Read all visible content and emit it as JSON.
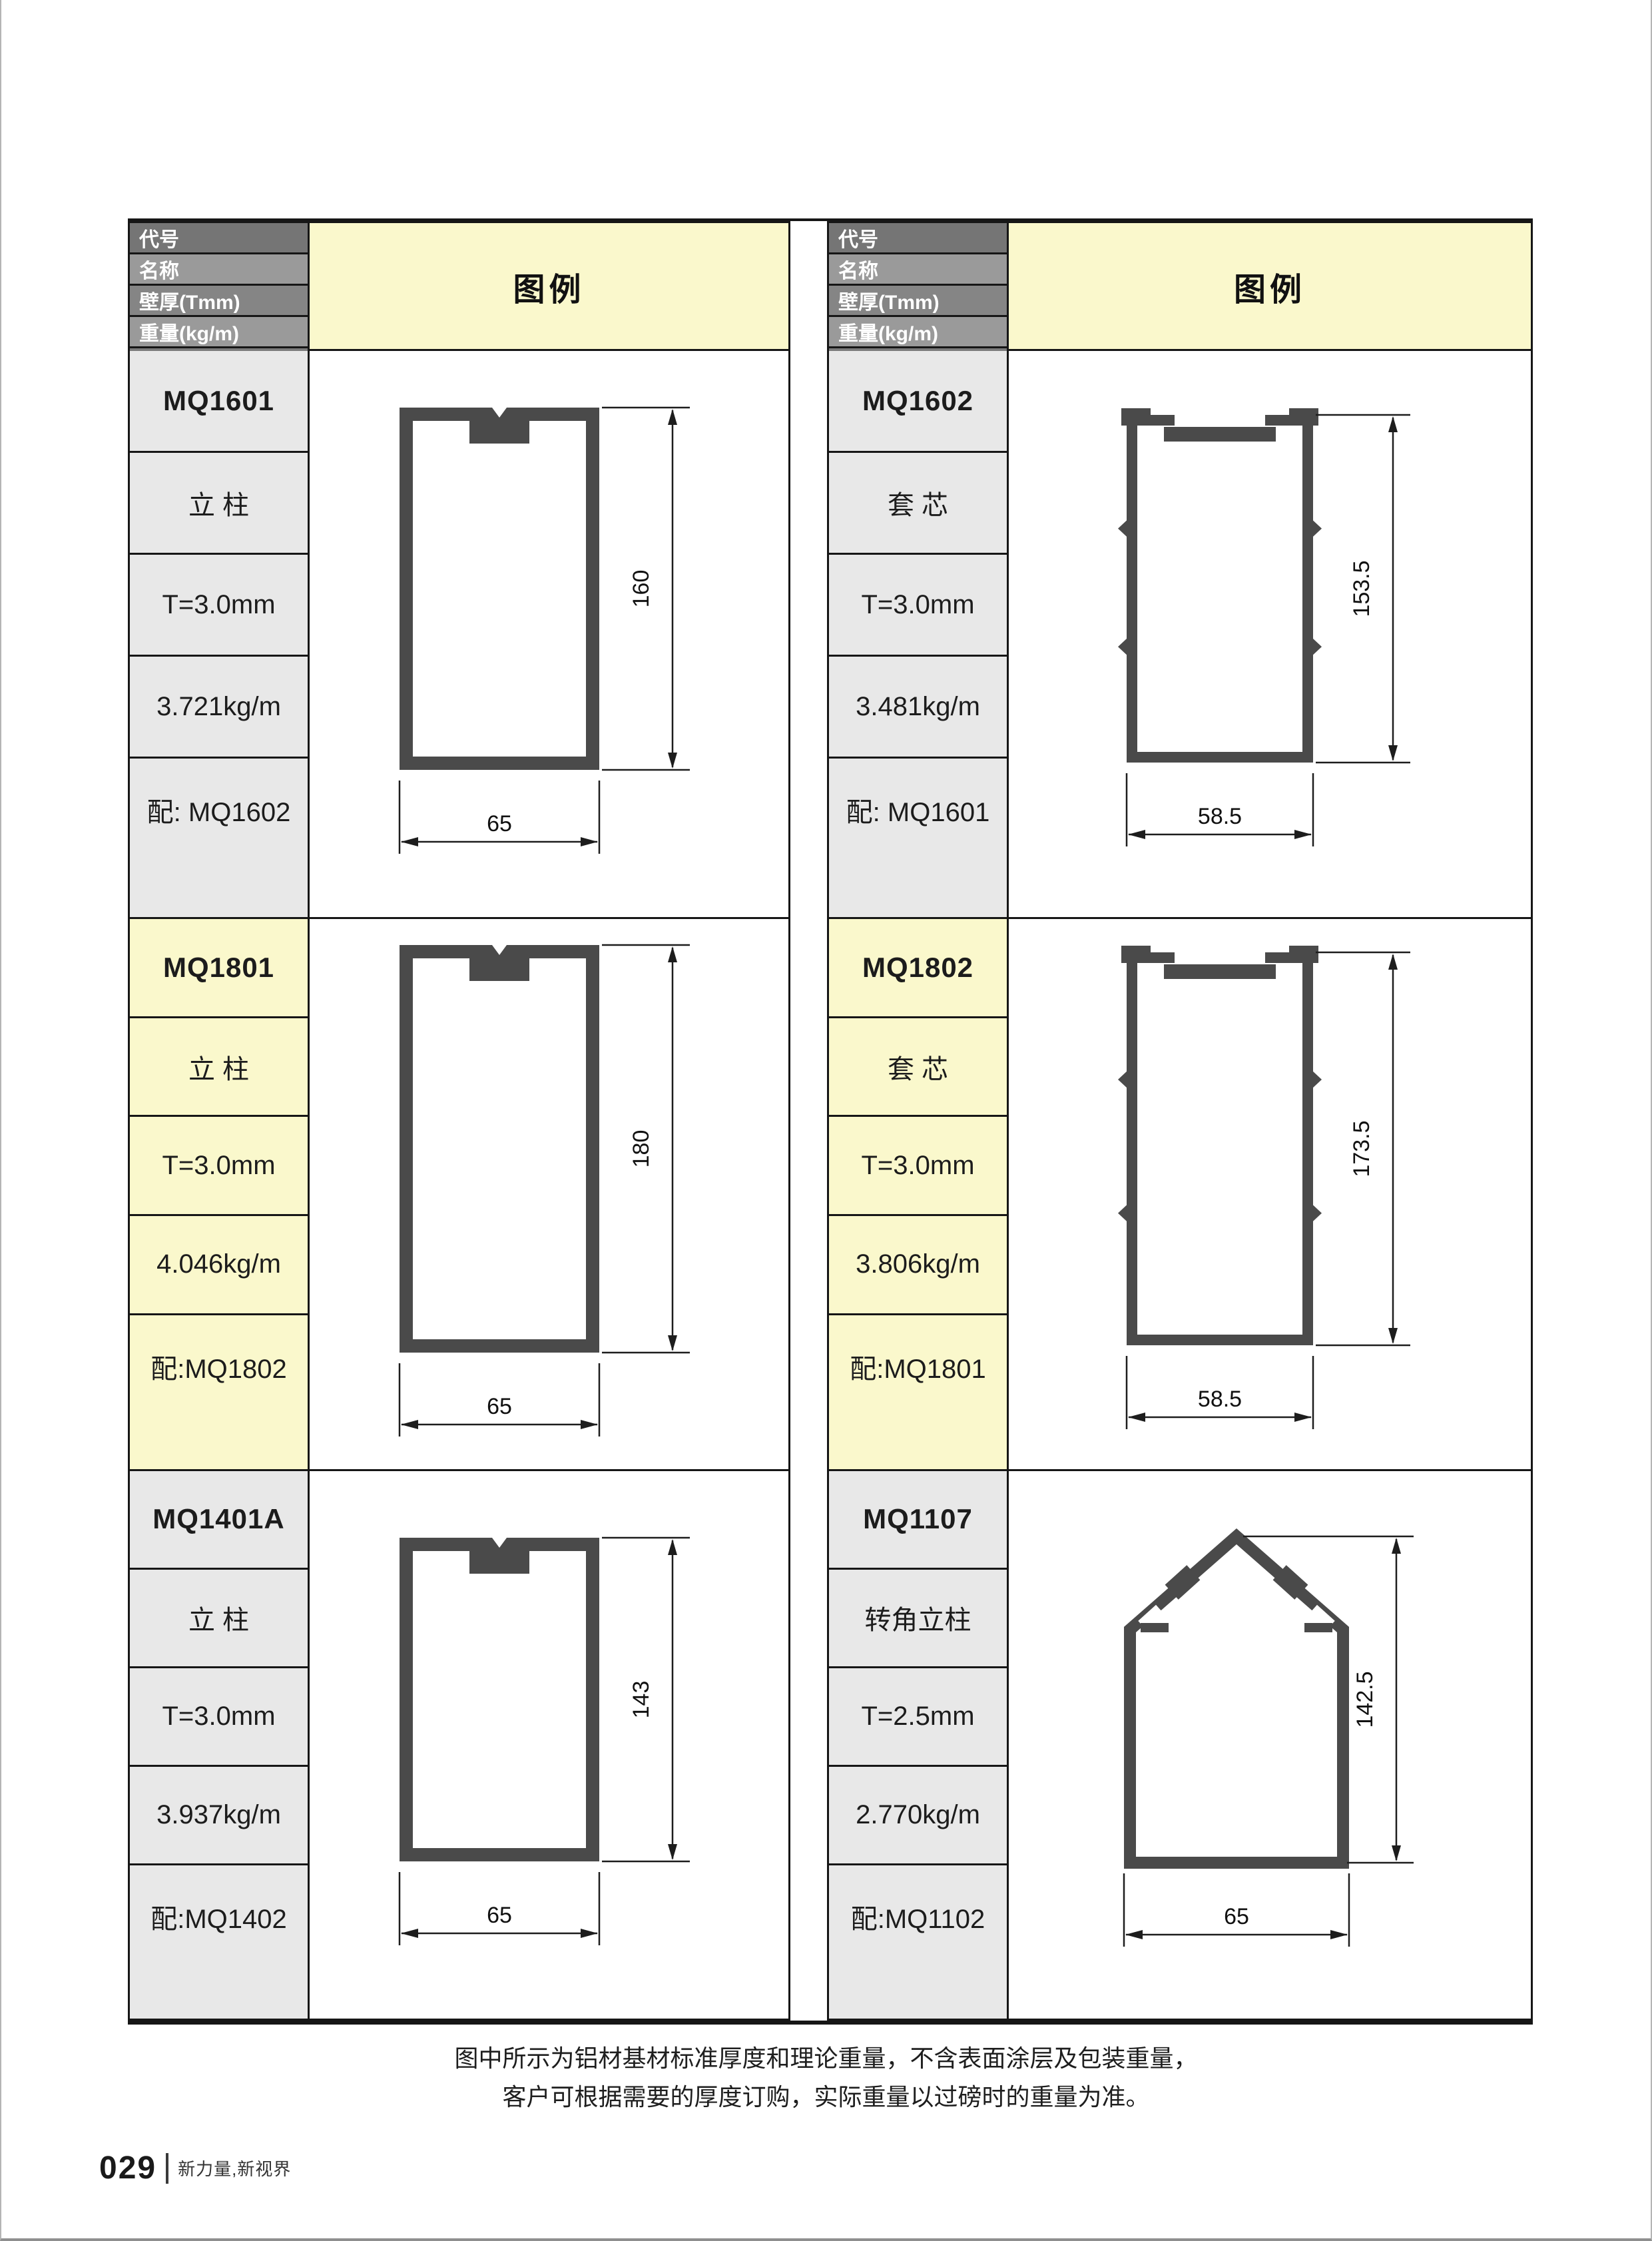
{
  "header": {
    "rows": [
      "代号",
      "名称",
      "壁厚(Tmm)",
      "重量(kg/m)",
      "配套"
    ],
    "legend_label": "图例"
  },
  "colors": {
    "legend_bg": "#FAF8CC",
    "section_gray": "#E8E8E8",
    "section_yellow": "#FAF8CC",
    "header_row_bgs": [
      "#757575",
      "#9A9A9A",
      "#858585",
      "#9A9A9A",
      "#7B7B7B"
    ],
    "profile_stroke": "#4A4A4A",
    "grid_line": "#161616"
  },
  "profiles": [
    {
      "code": "MQ1601",
      "name": "立 柱",
      "thickness": "T=3.0mm",
      "weight": "3.721kg/m",
      "match": "配: MQ1602",
      "shape": "mullion",
      "dim_h": "160",
      "dim_w": "65"
    },
    {
      "code": "MQ1602",
      "name": "套 芯",
      "thickness": "T=3.0mm",
      "weight": "3.481kg/m",
      "match": "配: MQ1601",
      "shape": "sleeve",
      "dim_h": "153.5",
      "dim_w": "58.5"
    },
    {
      "code": "MQ1801",
      "name": "立 柱",
      "thickness": "T=3.0mm",
      "weight": "4.046kg/m",
      "match": "配:MQ1802",
      "shape": "mullion",
      "dim_h": "180",
      "dim_w": "65"
    },
    {
      "code": "MQ1802",
      "name": "套 芯",
      "thickness": "T=3.0mm",
      "weight": "3.806kg/m",
      "match": "配:MQ1801",
      "shape": "sleeve",
      "dim_h": "173.5",
      "dim_w": "58.5"
    },
    {
      "code": "MQ1401A",
      "name": "立 柱",
      "thickness": "T=3.0mm",
      "weight": "3.937kg/m",
      "match": "配:MQ1402",
      "shape": "mullion",
      "dim_h": "143",
      "dim_w": "65"
    },
    {
      "code": "MQ1107",
      "name": "转角立柱",
      "thickness": "T=2.5mm",
      "weight": "2.770kg/m",
      "match": "配:MQ1102",
      "shape": "corner",
      "dim_h": "142.5",
      "dim_w": "65"
    }
  ],
  "footer": {
    "note_line1": "图中所示为铝材基材标准厚度和理论重量，不含表面涂层及包装重量，",
    "note_line2": "客户可根据需要的厚度订购，实际重量以过磅时的重量为准。",
    "page_number": "029",
    "tagline": "新力量,新视界"
  }
}
